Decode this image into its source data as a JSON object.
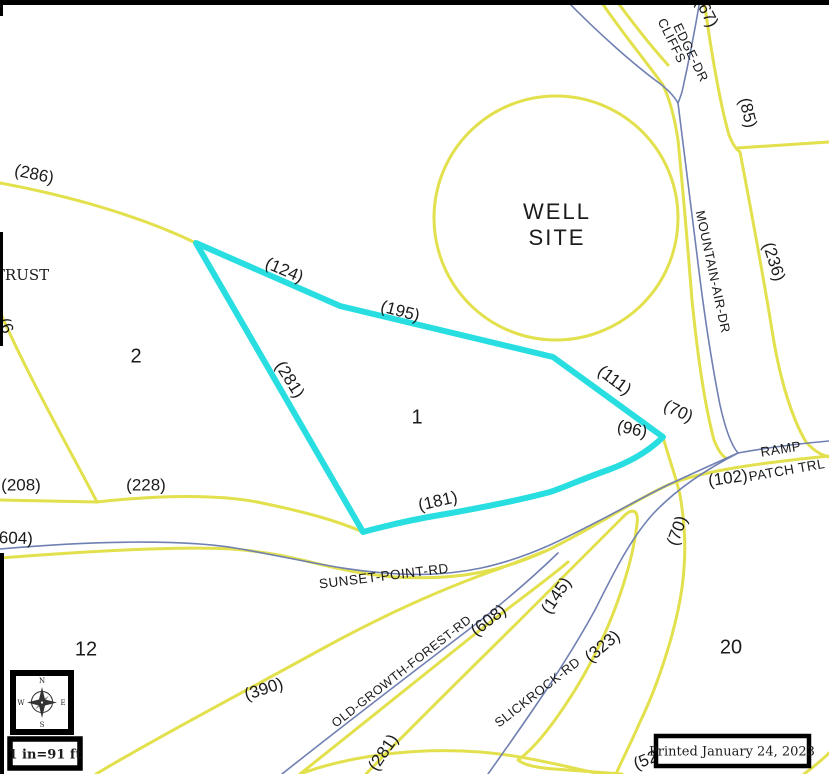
{
  "colors": {
    "parcel_line": "#e2e04d",
    "highlight": "#28dee0",
    "road": "#7080b2",
    "text": "#1b1b1b",
    "frame": "#000000"
  },
  "well_site": {
    "line1": "WELL",
    "line2": "SITE"
  },
  "owner_label": {
    "text": "TRUST"
  },
  "parcel_numbers": [
    {
      "text": "2",
      "x": 136,
      "y": 357
    },
    {
      "text": "1",
      "x": 417,
      "y": 418
    },
    {
      "text": "12",
      "x": 86,
      "y": 650
    },
    {
      "text": "20",
      "x": 731,
      "y": 648
    }
  ],
  "dimension_labels": [
    {
      "text": "(286)",
      "x": 34,
      "y": 175,
      "rot": 12
    },
    {
      "text": "(124)",
      "x": 284,
      "y": 271,
      "rot": 23
    },
    {
      "text": "(195)",
      "x": 400,
      "y": 312,
      "rot": 15
    },
    {
      "text": "(281)",
      "x": 289,
      "y": 380,
      "rot": 58
    },
    {
      "text": "(111)",
      "x": 614,
      "y": 381,
      "rot": 37
    },
    {
      "text": "(70)",
      "x": 678,
      "y": 412,
      "rot": 25
    },
    {
      "text": "(96)",
      "x": 632,
      "y": 430,
      "rot": 13
    },
    {
      "text": "(181)",
      "x": 438,
      "y": 502,
      "rot": -13
    },
    {
      "text": "(208)",
      "x": 21,
      "y": 486,
      "rot": 0
    },
    {
      "text": "(228)",
      "x": 146,
      "y": 486,
      "rot": 0
    },
    {
      "text": "(604)",
      "x": 13,
      "y": 539,
      "rot": 2
    },
    {
      "text": "(102)",
      "x": 728,
      "y": 479,
      "rot": -8
    },
    {
      "text": "(85)",
      "x": 747,
      "y": 113,
      "rot": 76
    },
    {
      "text": "(236)",
      "x": 773,
      "y": 262,
      "rot": 72
    },
    {
      "text": "(67)",
      "x": 706,
      "y": 13,
      "rot": 62
    },
    {
      "text": "(390)",
      "x": 264,
      "y": 690,
      "rot": -18
    },
    {
      "text": "(608)",
      "x": 489,
      "y": 621,
      "rot": -38
    },
    {
      "text": "(281)",
      "x": 384,
      "y": 753,
      "rot": -56
    },
    {
      "text": "(145)",
      "x": 557,
      "y": 596,
      "rot": -56
    },
    {
      "text": "(323)",
      "x": 603,
      "y": 647,
      "rot": -40
    },
    {
      "text": "(70)",
      "x": 678,
      "y": 531,
      "rot": -70
    },
    {
      "text": "(52",
      "x": 646,
      "y": 761,
      "rot": -22
    },
    {
      "text": "(6",
      "x": 5,
      "y": 326,
      "rot": 70
    }
  ],
  "road_labels": [
    {
      "text": "MOUNTAIN-AIR-DR",
      "x": 712,
      "y": 272,
      "rot": 78,
      "size": 13
    },
    {
      "text": "CLIFFS",
      "x": 671,
      "y": 41,
      "rot": 64,
      "size": 13
    },
    {
      "text": "EDGE-DR",
      "x": 690,
      "y": 53,
      "rot": 64,
      "size": 13
    },
    {
      "text": "RAMP",
      "x": 781,
      "y": 450,
      "rot": -9,
      "size": 13.5
    },
    {
      "text": "PATCH TRL",
      "x": 787,
      "y": 471,
      "rot": -10,
      "size": 13.5
    },
    {
      "text": "SUNSET-POINT-RD",
      "x": 384,
      "y": 577,
      "rot": -7,
      "size": 13.5
    },
    {
      "text": "OLD-GROWTH-FOREST-RD",
      "x": 402,
      "y": 672,
      "rot": -38,
      "size": 12.5
    },
    {
      "text": "SLICKROCK-RD",
      "x": 538,
      "y": 693,
      "rot": -38,
      "size": 13
    }
  ],
  "compass": {
    "n": "N",
    "e": "E",
    "s": "S",
    "w": "W"
  },
  "scale_box": {
    "text": "1 in=91 ft"
  },
  "printed_box": {
    "text": "Printed January 24, 2023"
  }
}
